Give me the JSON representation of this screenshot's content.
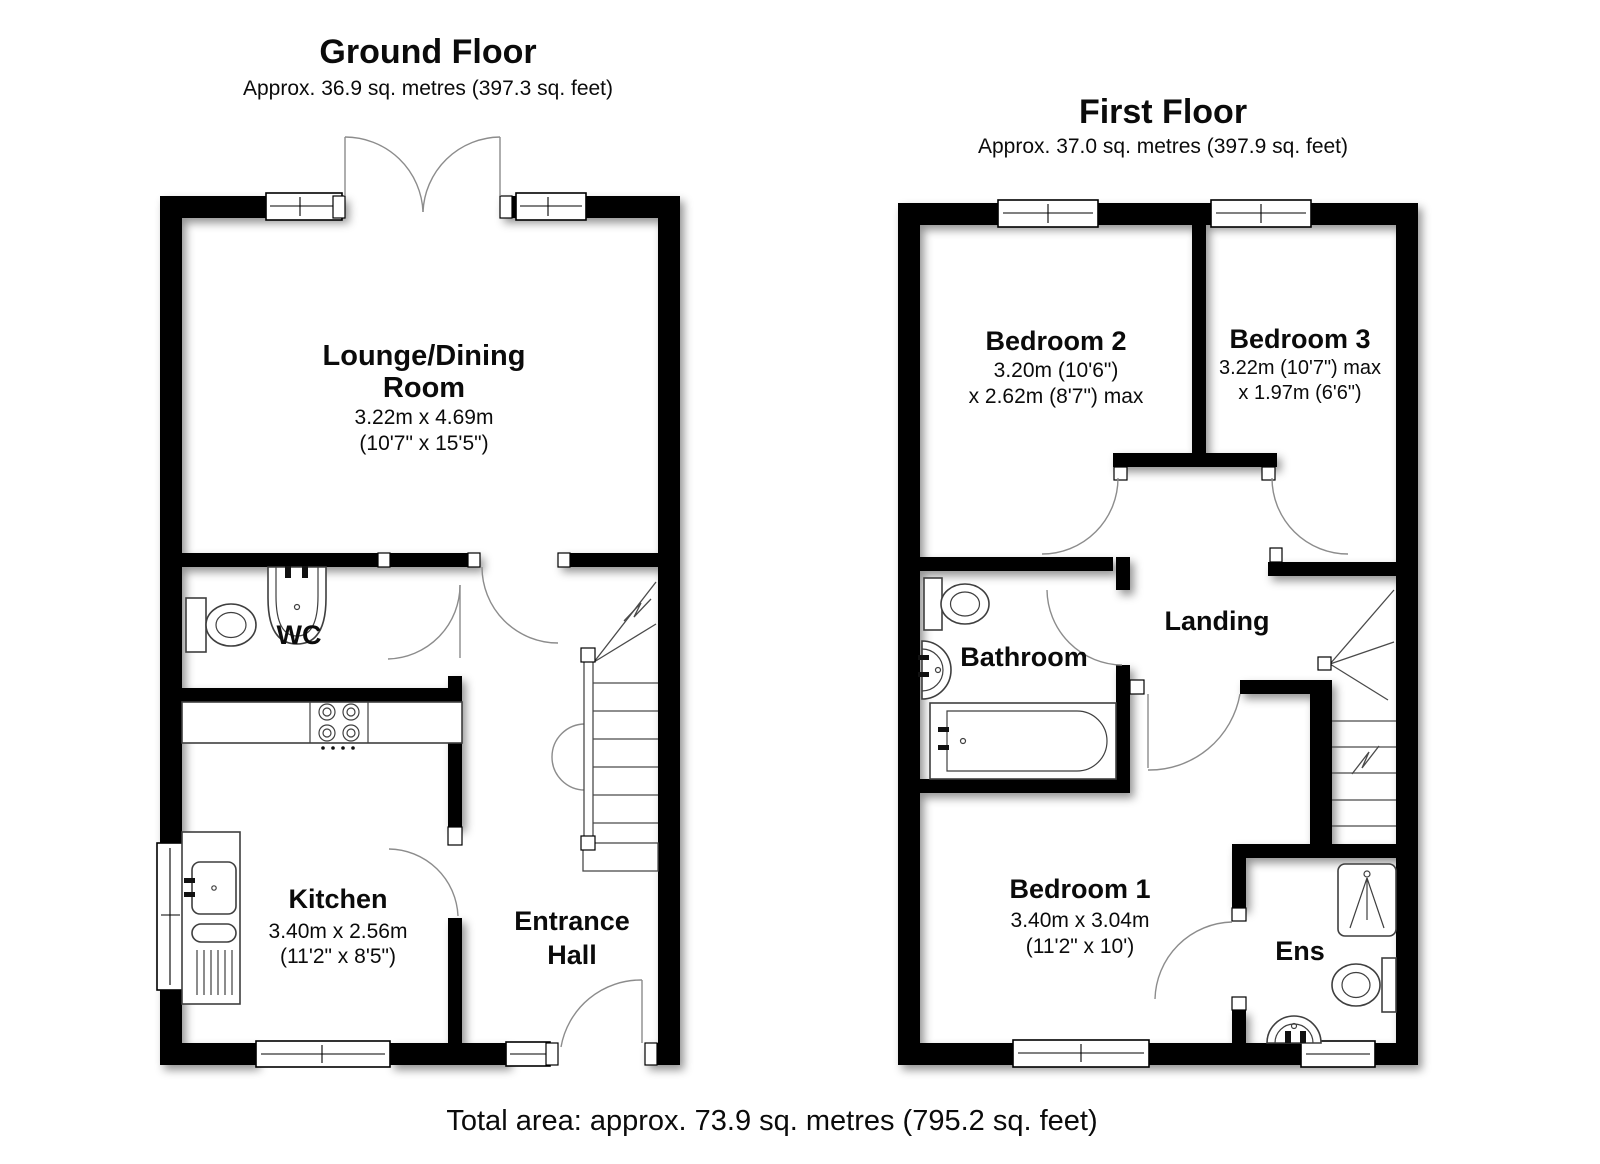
{
  "ground_floor": {
    "title": "Ground Floor",
    "area": "Approx. 36.9 sq. metres (397.3 sq. feet)",
    "rooms": {
      "lounge": {
        "line1": "Lounge/Dining",
        "line2": "Room",
        "metric": "3.22m x 4.69m",
        "imperial": "(10'7\" x 15'5\")"
      },
      "wc": {
        "name": "WC"
      },
      "kitchen": {
        "name": "Kitchen",
        "metric": "3.40m x 2.56m",
        "imperial": "(11'2\" x 8'5\")"
      },
      "entrance_hall": {
        "line1": "Entrance",
        "line2": "Hall"
      }
    }
  },
  "first_floor": {
    "title": "First Floor",
    "area": "Approx. 37.0 sq. metres (397.9 sq. feet)",
    "rooms": {
      "bedroom2": {
        "name": "Bedroom 2",
        "dim1": "3.20m (10'6\")",
        "dim2": "x 2.62m (8'7\") max"
      },
      "bedroom3": {
        "name": "Bedroom 3",
        "dim1": "3.22m (10'7\") max",
        "dim2": "x 1.97m (6'6\")"
      },
      "landing": {
        "name": "Landing"
      },
      "bathroom": {
        "name": "Bathroom"
      },
      "bedroom1": {
        "name": "Bedroom 1",
        "metric": "3.40m x 3.04m",
        "imperial": "(11'2\" x 10')"
      },
      "ensuite": {
        "name": "Ens"
      }
    }
  },
  "footer": {
    "total_area": "Total area: approx. 73.9 sq. metres (795.2 sq. feet)"
  },
  "colors": {
    "wall": "#000000",
    "background": "#ffffff",
    "door_arc": "#8c8c8c",
    "text": "#0b0b0b"
  }
}
